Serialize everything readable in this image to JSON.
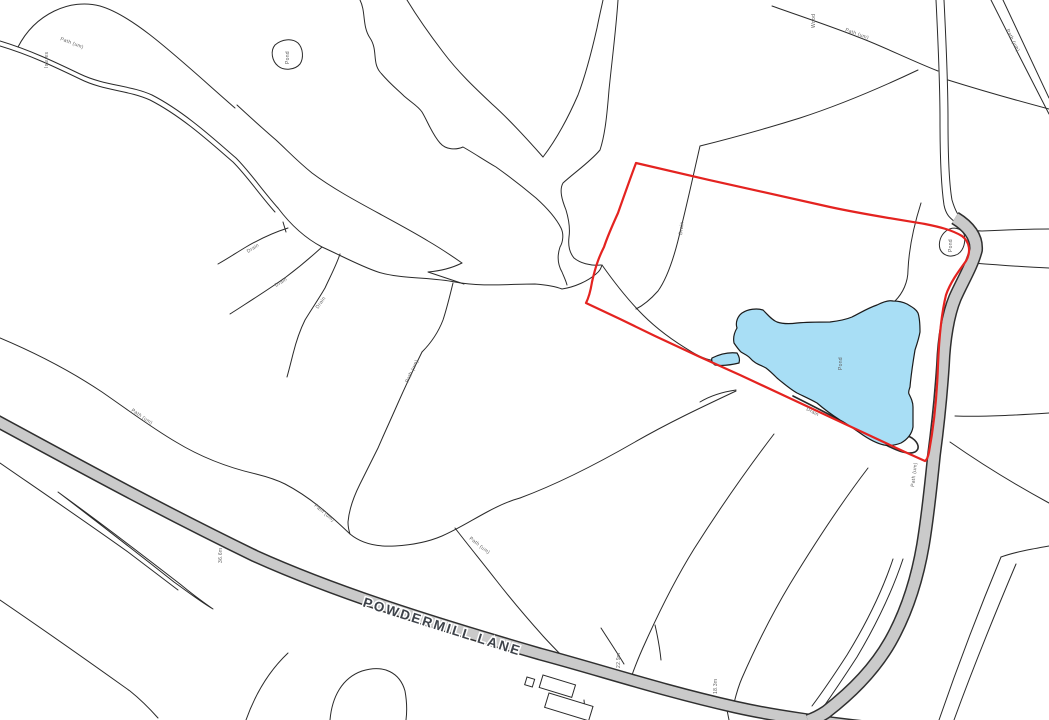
{
  "map": {
    "type": "ordnance-survey-style site plan",
    "background_color": "#ffffff",
    "colors": {
      "bg": "#ffffff",
      "line": "#2a2a2a",
      "red": "#e42320",
      "pond_fill": "#a8def5",
      "pond_stroke": "#1b1b1b",
      "road_fill": "#cacaca",
      "road_casing": "#2f2f2f",
      "label": "#606060",
      "road_name": "#3d4249",
      "halo": "#ffffff"
    },
    "road_name": "POWDERMILL LANE",
    "labels": [
      {
        "text": "POWDERMILL LANE",
        "x": 441,
        "y": 631,
        "rotation": 17.5,
        "kind": "road-name"
      },
      {
        "text": "Wood",
        "x": 815,
        "y": 28,
        "rotation": -90,
        "kind": "small"
      },
      {
        "text": "Path (um)",
        "x": 845,
        "y": 31,
        "rotation": 20,
        "kind": "small"
      },
      {
        "text": "Path (um)",
        "x": 1006,
        "y": 30,
        "rotation": 63,
        "kind": "small"
      },
      {
        "text": "Path (um)",
        "x": 60,
        "y": 40,
        "rotation": 21,
        "kind": "small"
      },
      {
        "text": "Issues",
        "x": 48,
        "y": 68,
        "rotation": -90,
        "kind": "small"
      },
      {
        "text": "Pond",
        "x": 289,
        "y": 64,
        "rotation": -90,
        "kind": "small"
      },
      {
        "text": "Pond",
        "x": 952,
        "y": 252,
        "rotation": -90,
        "kind": "small"
      },
      {
        "text": "Pond",
        "x": 842,
        "y": 370,
        "rotation": -90,
        "kind": "small"
      },
      {
        "text": "Drain",
        "x": 682,
        "y": 235,
        "rotation": -83,
        "kind": "small"
      },
      {
        "text": "Drain",
        "x": 248,
        "y": 253,
        "rotation": -32,
        "kind": "small"
      },
      {
        "text": "Drain",
        "x": 276,
        "y": 287,
        "rotation": -32,
        "kind": "small"
      },
      {
        "text": "Drain",
        "x": 318,
        "y": 309,
        "rotation": -55,
        "kind": "small"
      },
      {
        "text": "Drain",
        "x": 806,
        "y": 410,
        "rotation": 28,
        "kind": "small"
      },
      {
        "text": "Path (um)",
        "x": 408,
        "y": 383,
        "rotation": -65,
        "kind": "small"
      },
      {
        "text": "Path (um)",
        "x": 131,
        "y": 411,
        "rotation": 34,
        "kind": "small"
      },
      {
        "text": "Path (um)",
        "x": 314,
        "y": 506,
        "rotation": 40,
        "kind": "small"
      },
      {
        "text": "Path (um)",
        "x": 469,
        "y": 539,
        "rotation": 38,
        "kind": "small"
      },
      {
        "text": "Path (um)",
        "x": 914,
        "y": 487,
        "rotation": -83,
        "kind": "small"
      },
      {
        "text": "36.6m",
        "x": 222,
        "y": 563,
        "rotation": -90,
        "kind": "tiny"
      },
      {
        "text": "22.9m",
        "x": 620,
        "y": 668,
        "rotation": -90,
        "kind": "tiny"
      },
      {
        "text": "18.3m",
        "x": 717,
        "y": 694,
        "rotation": -90,
        "kind": "tiny"
      }
    ]
  }
}
